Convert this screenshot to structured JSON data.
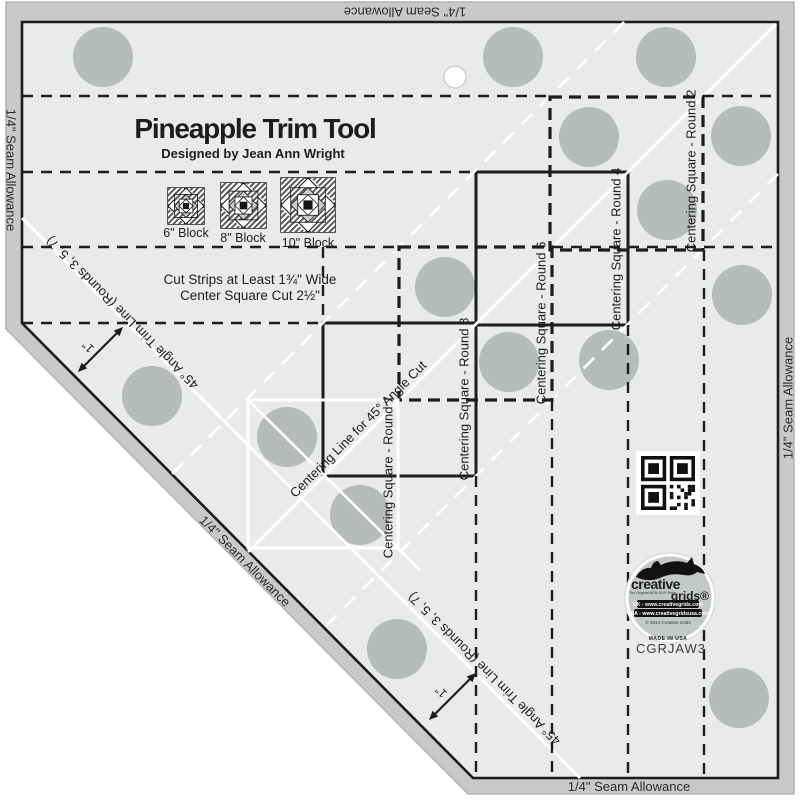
{
  "ruler": {
    "title": "Pineapple Trim Tool",
    "subtitle": "Designed by Jean Ann Wright",
    "instructions": {
      "line1": "Cut Strips at Least 1¾\" Wide",
      "line2": "Center Square Cut 2½\""
    },
    "seam_allowance_label": "1/4\" Seam Allowance",
    "angle_trim_line_label": "45° Angle Trim Line (Rounds 3, 5, 7)",
    "centering_line_label": "Centering Line for 45° Angle Cut",
    "one_inch_label": "1\"",
    "product_code": "CGRJAW3",
    "blocks": [
      {
        "label": "6\" Block"
      },
      {
        "label": "8\" Block"
      },
      {
        "label": "10\" Block"
      }
    ],
    "centering_squares": [
      {
        "round": 2,
        "label": "Centering Square - Round 2",
        "style": "dashed"
      },
      {
        "round": 4,
        "label": "Centering Square - Round 4",
        "style": "solid"
      },
      {
        "round": 6,
        "label": "Centering Square - Round 6",
        "style": "dashed"
      },
      {
        "round": 8,
        "label": "Centering Square - Round 8",
        "style": "solid"
      },
      {
        "round": 1,
        "label": "Centering Square - Round 1",
        "style": "white"
      }
    ],
    "logo": {
      "brand_top": "creative",
      "brand_bottom": "grids®",
      "tagline": "The Original NON-SLIP Ruler",
      "line_uk": "UK - www.creativegrids.com",
      "line_usa": "USA - www.creativegridsusa.com",
      "line_copyright": "© 2014 Creative Grids",
      "line_made": "MADE IN USA"
    },
    "colors": {
      "body": "#e9eaea",
      "edge_band": "#c8caca",
      "grip_dot": "#b7bbbb",
      "ink": "#1d1d1d",
      "white_line": "#ffffff"
    }
  }
}
